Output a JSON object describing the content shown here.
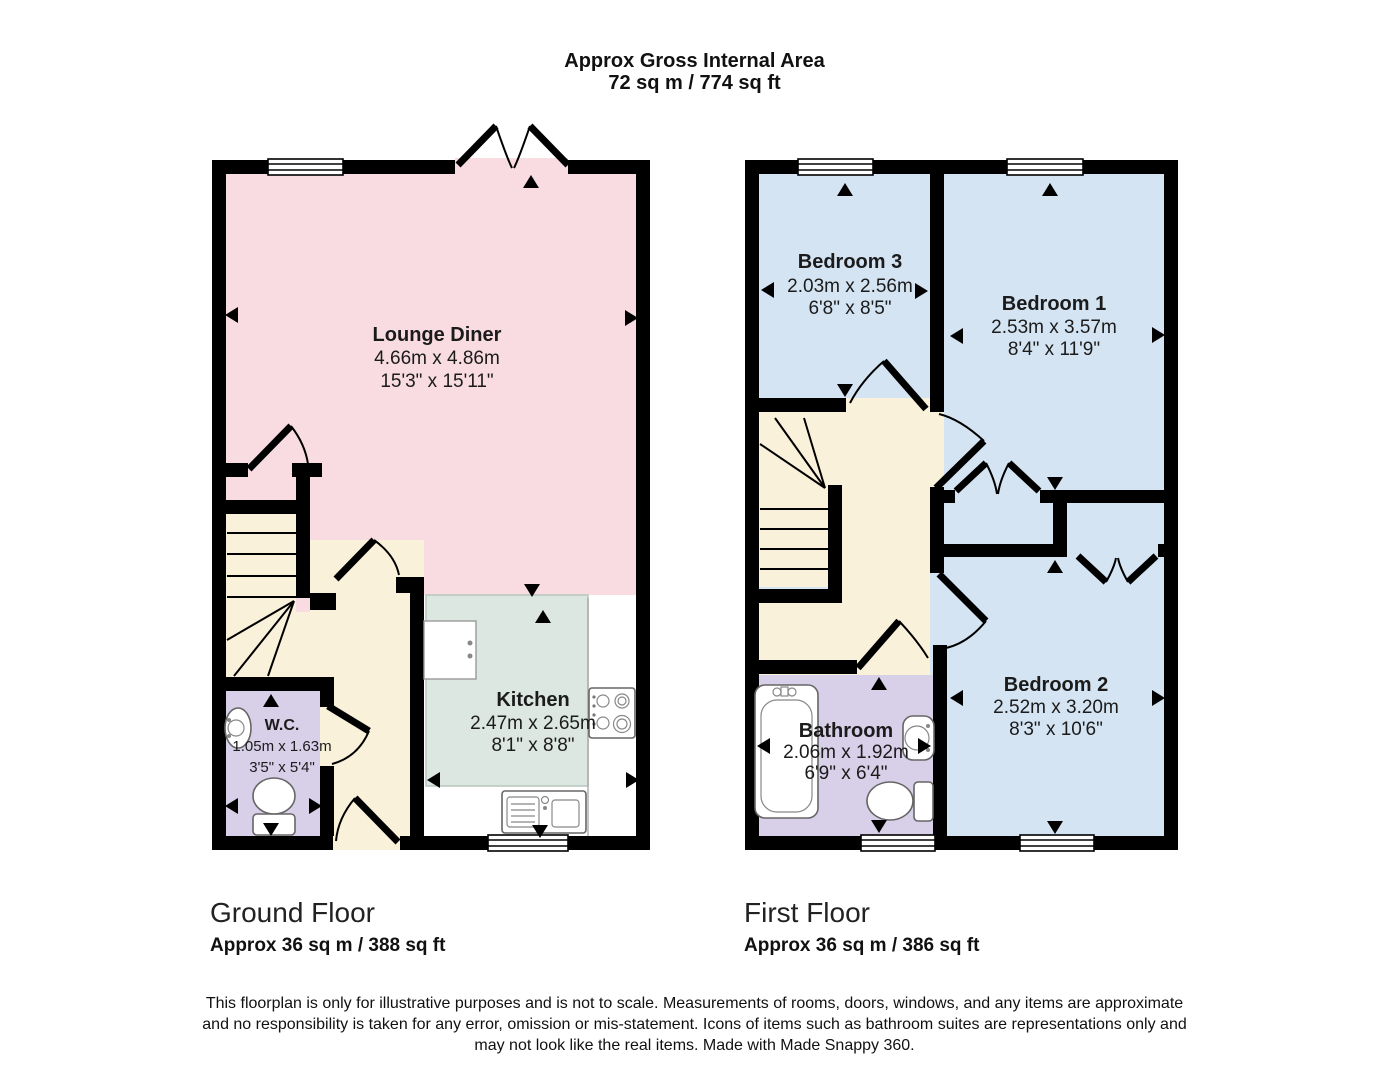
{
  "title": {
    "line1": "Approx Gross Internal Area",
    "line2": "72 sq m / 774 sq ft"
  },
  "ground_floor": {
    "name": "Ground Floor",
    "area": "Approx 36 sq m / 388 sq ft",
    "rooms": {
      "lounge": {
        "name": "Lounge Diner",
        "metric": "4.66m x 4.86m",
        "imperial": "15'3\" x 15'11\""
      },
      "kitchen": {
        "name": "Kitchen",
        "metric": "2.47m x 2.65m",
        "imperial": "8'1\" x 8'8\""
      },
      "wc": {
        "name": "W.C.",
        "metric": "1.05m x 1.63m",
        "imperial": "3'5\" x 5'4\""
      }
    }
  },
  "first_floor": {
    "name": "First Floor",
    "area": "Approx 36 sq m / 386 sq ft",
    "rooms": {
      "bedroom3": {
        "name": "Bedroom 3",
        "metric": "2.03m x 2.56m",
        "imperial": "6'8\" x 8'5\""
      },
      "bedroom1": {
        "name": "Bedroom 1",
        "metric": "2.53m x 3.57m",
        "imperial": "8'4\" x 11'9\""
      },
      "bedroom2": {
        "name": "Bedroom 2",
        "metric": "2.52m x 3.20m",
        "imperial": "8'3\" x 10'6\""
      },
      "bathroom": {
        "name": "Bathroom",
        "metric": "2.06m x 1.92m",
        "imperial": "6'9\" x 6'4\""
      }
    }
  },
  "disclaimer": {
    "lines": {
      "0": "This floorplan is only for illustrative purposes and is not to scale. Measurements of rooms, doors, windows, and any items are approximate",
      "1": "and no responsibility is taken for any error, omission or mis-statement. Icons of items such as bathroom suites are representations only and",
      "2": "may not look like the real items. Made with Made Snappy 360."
    }
  },
  "colors": {
    "lounge_pink": "#F8DCE2",
    "kitchen_mint": "#DBE7E0",
    "hall_cream": "#FAF1DA",
    "wet_room_purple": "#D8CFE8",
    "bedroom_blue": "#D5E4F3",
    "wall_black": "#000000"
  }
}
